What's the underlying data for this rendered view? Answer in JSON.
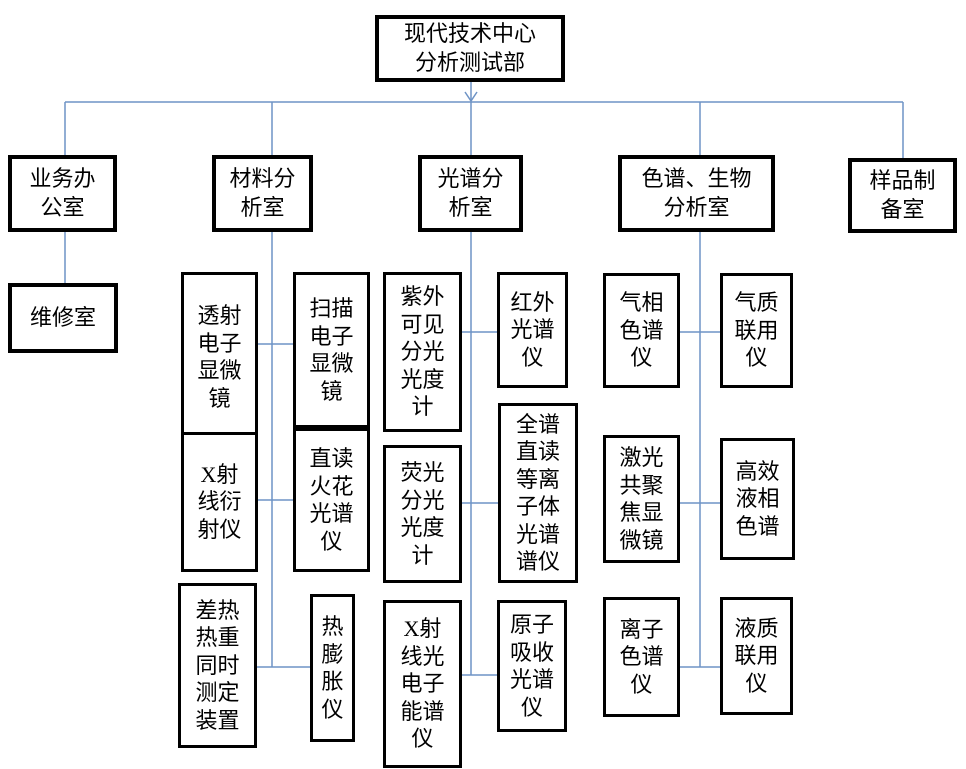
{
  "colors": {
    "line": "#6e93c5",
    "box_border": "#000000",
    "background": "#ffffff"
  },
  "root": {
    "label": "现代技术中心\n分析测试部"
  },
  "departments": [
    {
      "label": "业务办\n公室",
      "units": [
        "维修室"
      ]
    },
    {
      "label": "材料分\n析室",
      "units": [
        "透射\n电子\n显微\n镜",
        "扫描\n电子\n显微\n镜",
        "X射\n线衍\n射仪",
        "直读\n火花\n光谱\n仪",
        "差热\n热重\n同时\n测定\n装置",
        "热\n膨\n胀\n仪"
      ]
    },
    {
      "label": "光谱分\n析室",
      "units": [
        "紫外\n可见\n分光\n光度\n计",
        "红外\n光谱\n仪",
        "荧光\n分光\n光度\n计",
        "全谱\n直读\n等离\n子体\n光谱\n谱仪",
        "X射\n线光\n电子\n能谱\n仪",
        "原子\n吸收\n光谱\n仪"
      ]
    },
    {
      "label": "色谱、生物\n分析室",
      "units": [
        "气相\n色谱\n仪",
        "气质\n联用\n仪",
        "激光\n共聚\n焦显\n微镜",
        "高效\n液相\n色谱",
        "离子\n色谱\n仪",
        "液质\n联用\n仪"
      ]
    },
    {
      "label": "样品制\n备室",
      "units": []
    }
  ]
}
